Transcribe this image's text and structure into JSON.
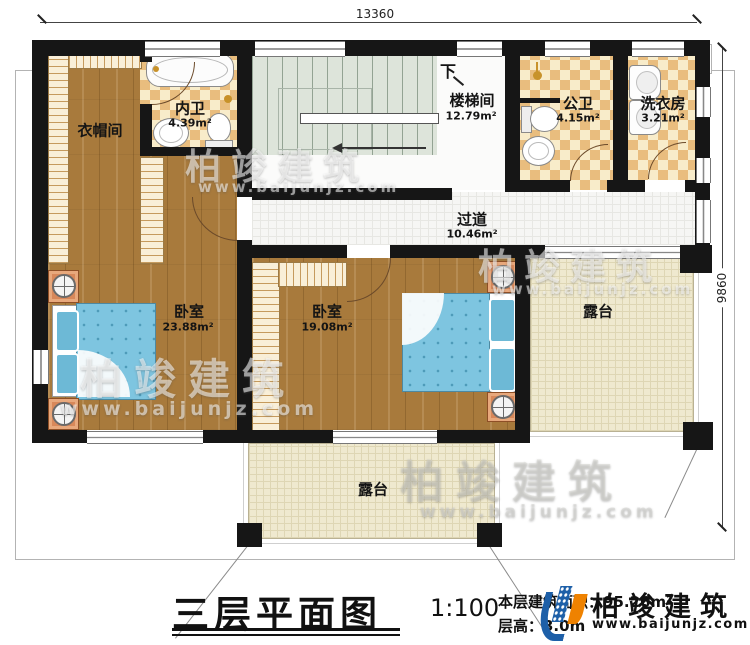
{
  "dimensions": {
    "top": "13360",
    "right": "9860"
  },
  "rooms": [
    {
      "id": "cloakroom",
      "label": "衣帽间",
      "area": ""
    },
    {
      "id": "inner-bathroom",
      "label": "内卫",
      "area": "4.39m²"
    },
    {
      "id": "stairwell",
      "label": "楼梯间",
      "area": "12.79m²"
    },
    {
      "id": "public-bathroom",
      "label": "公卫",
      "area": "4.15m²"
    },
    {
      "id": "laundry-room",
      "label": "洗衣房",
      "area": "3.21m²"
    },
    {
      "id": "corridor",
      "label": "过道",
      "area": "10.46m²"
    },
    {
      "id": "bedroom-left",
      "label": "卧室",
      "area": "23.88m²"
    },
    {
      "id": "bedroom-center",
      "label": "卧室",
      "area": "19.08m²"
    },
    {
      "id": "terrace-right",
      "label": "露台",
      "area": ""
    },
    {
      "id": "terrace-bottom",
      "label": "露台",
      "area": ""
    }
  ],
  "stair": {
    "down_label": "下"
  },
  "title_block": {
    "title": "三层平面图",
    "scale": "1:100",
    "area_label": "本层建筑面积：95.26m²",
    "height_label": "层高：3.0m"
  },
  "logo": {
    "name": "柏竣建筑",
    "url": "www.baijunjz.com"
  },
  "watermark": {
    "name": "柏竣建筑",
    "url": "www.baijunjz.com"
  },
  "colors": {
    "wall": "#161616",
    "wood_floor": "#a87a3c",
    "tile": "#e9bd7e",
    "stair": "#dde4da",
    "terrace": "#efe9cf",
    "bed": "#7ec5e0",
    "nightstand": "#d8885a",
    "logo_blue": "#1d5fa8",
    "logo_orange": "#ef8200"
  }
}
